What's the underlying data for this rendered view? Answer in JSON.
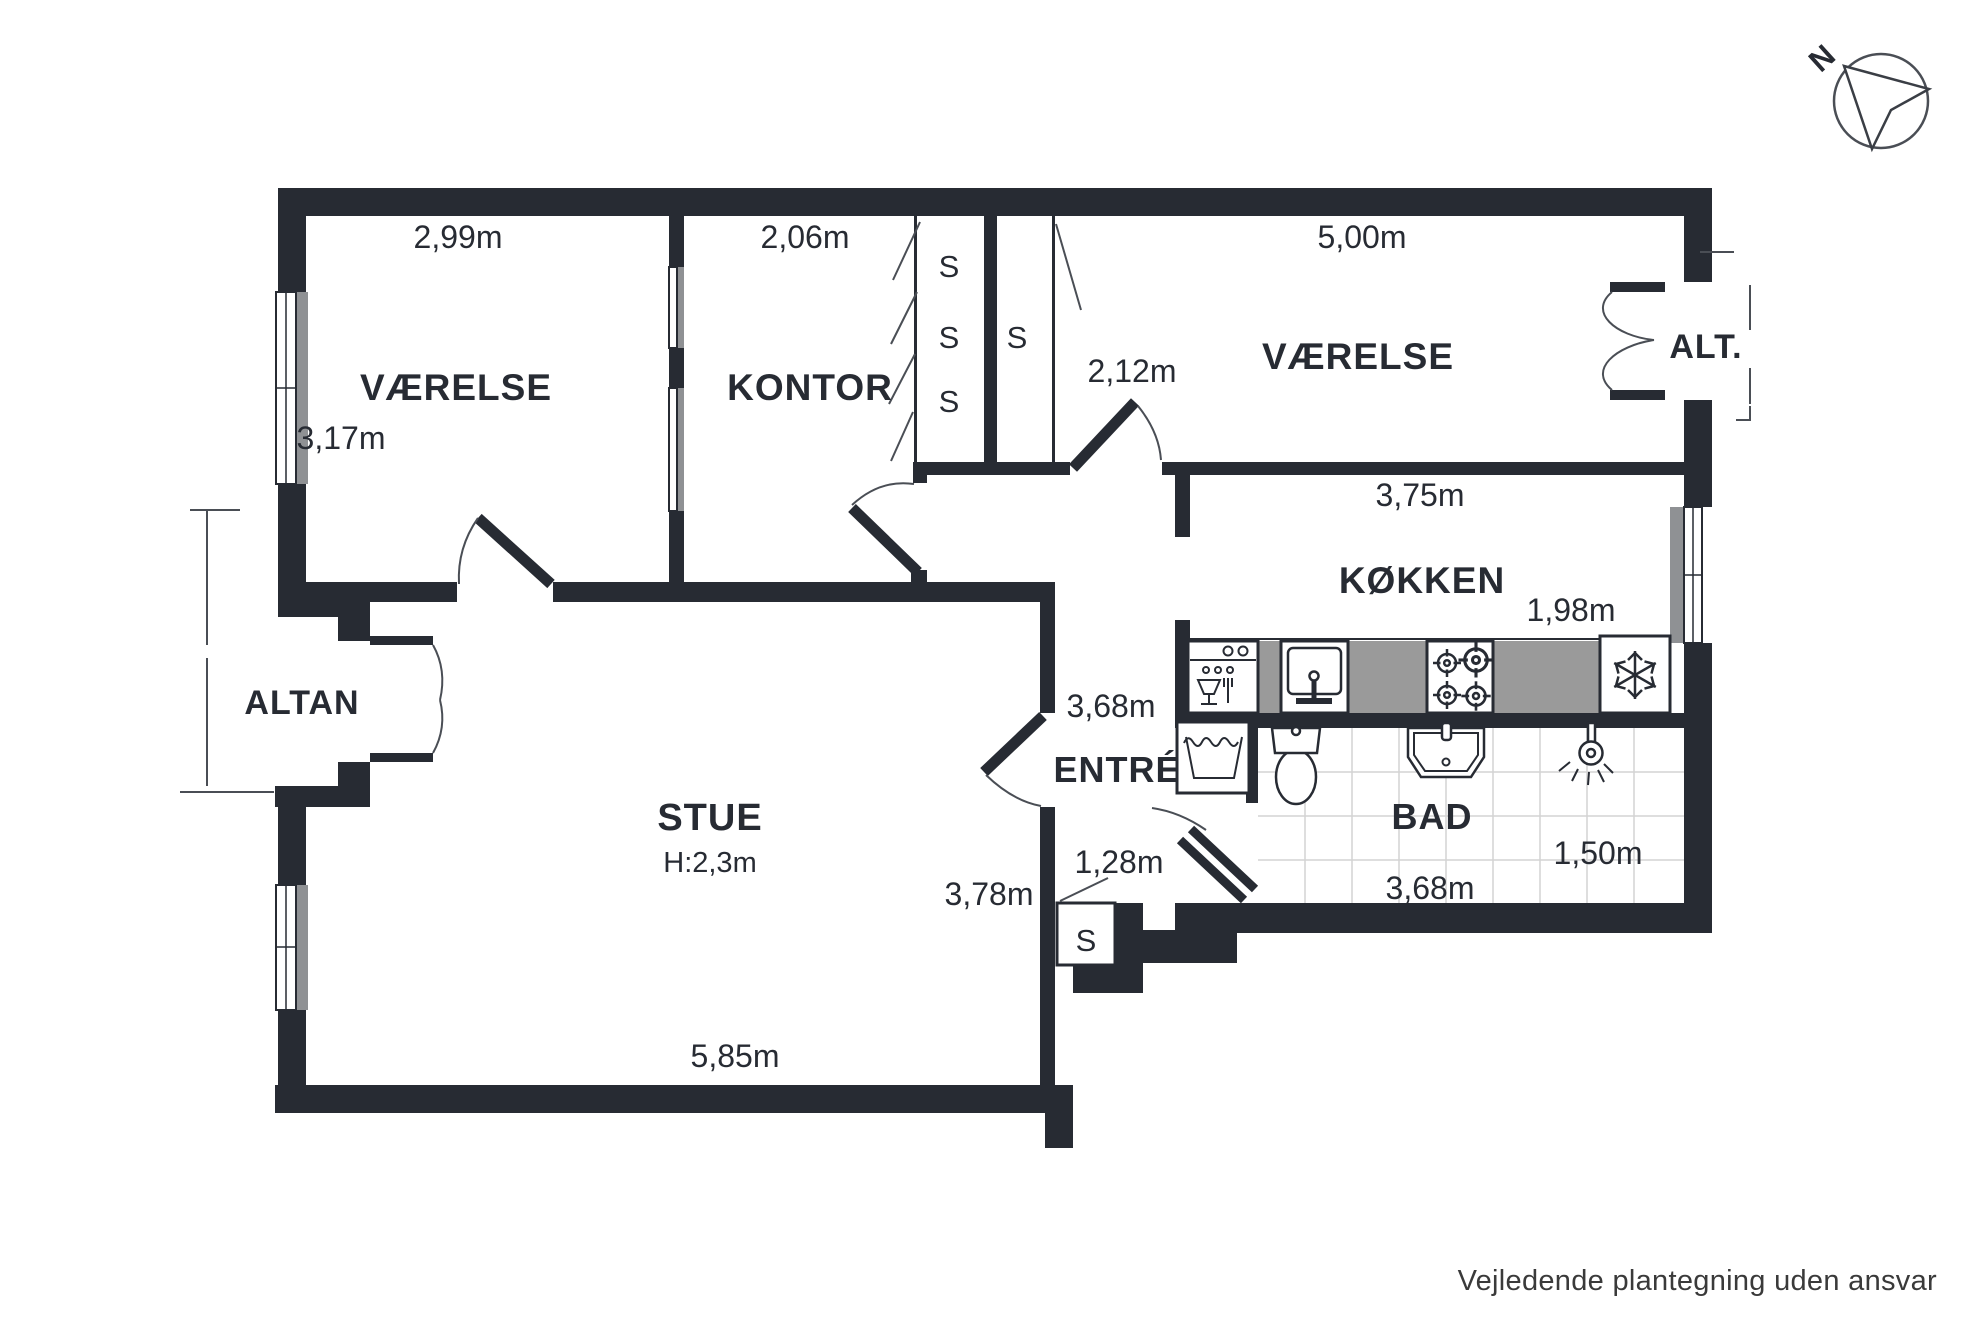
{
  "colors": {
    "wall": "#272b33",
    "counter_gray": "#9a9a9a",
    "window_gray": "#8f9194",
    "tile_line": "#d4d4d4",
    "thin_line": "#4a4e55",
    "text": "#272b33",
    "footer_text": "#3a3a3a",
    "background": "#ffffff"
  },
  "compass": {
    "north_label": "N"
  },
  "footer": {
    "disclaimer": "Vejledende plantegning uden ansvar"
  },
  "closet_label": "S",
  "rooms": {
    "vaerelse_nw": {
      "name": "VÆRELSE",
      "width": "2,99m",
      "depth": "3,17m"
    },
    "kontor": {
      "name": "KONTOR",
      "width": "2,06m"
    },
    "vaerelse_ne": {
      "name": "VÆRELSE",
      "width": "5,00m",
      "entry_width": "2,12m"
    },
    "koekken": {
      "name": "KØKKEN",
      "width": "3,75m",
      "depth": "1,98m"
    },
    "stue": {
      "name": "STUE",
      "ceiling_height": "H:2,3m",
      "width": "5,85m",
      "depth": "3,78m"
    },
    "entre": {
      "name": "ENTRÉ",
      "width": "3,68m",
      "closet_width": "1,28m"
    },
    "bad": {
      "name": "BAD",
      "width": "3,68m",
      "depth": "1,50m"
    },
    "altan": {
      "name": "ALTAN"
    },
    "alt": {
      "name": "ALT."
    }
  }
}
